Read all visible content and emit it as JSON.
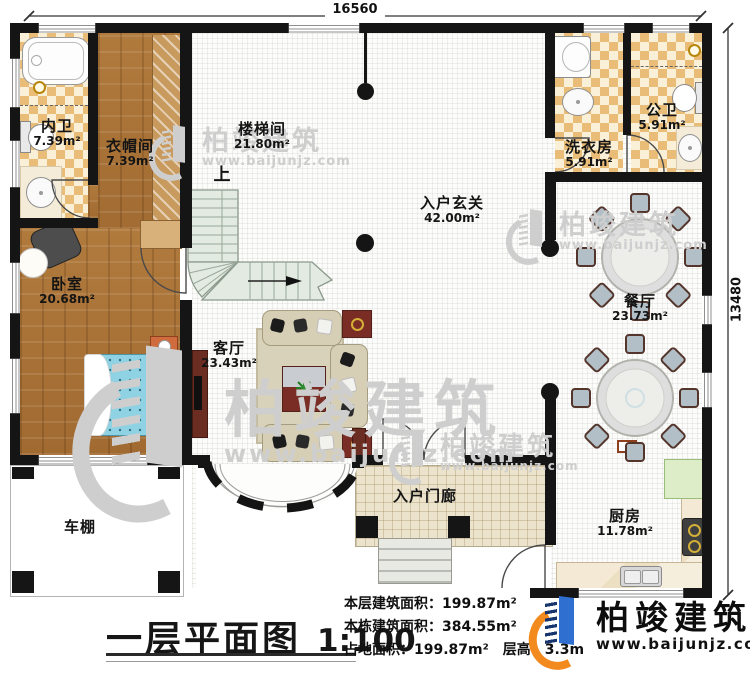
{
  "plan": {
    "title": "一层平面图",
    "scale": "1:100",
    "dimension_top": "16560",
    "dimension_right": "13480",
    "stair_direction_label": "上"
  },
  "rooms": [
    {
      "name": "内卫",
      "area": "7.39m²"
    },
    {
      "name": "衣帽间",
      "area": "7.39m²"
    },
    {
      "name": "楼梯间",
      "area": "21.80m²"
    },
    {
      "name": "入户玄关",
      "area": "42.00m²"
    },
    {
      "name": "洗衣房",
      "area": "5.91m²"
    },
    {
      "name": "公卫",
      "area": "5.91m²"
    },
    {
      "name": "卧室",
      "area": "20.68m²"
    },
    {
      "name": "客厅",
      "area": "23.43m²"
    },
    {
      "name": "餐厅",
      "area": "23.73m²"
    },
    {
      "name": "厨房",
      "area": "11.78m²"
    },
    {
      "name": "入户门廊",
      "area": ""
    },
    {
      "name": "车棚",
      "area": ""
    }
  ],
  "stats": {
    "floor_area": "本层建筑面积：199.87m²",
    "building_area": "本栋建筑面积：384.55m²",
    "land_area_and_height": "占地面积：199.87m²　层高：3.3m"
  },
  "branding": {
    "name": "柏竣建筑",
    "url": "www.baijunjz.com"
  },
  "colors": {
    "wall": "#151515",
    "wood_floor": "#ad7336",
    "tile_accent": "#e9bd77",
    "stair": "#e3eae2",
    "bed": "#8ed2e4",
    "brand_orange": "#f28a1e",
    "brand_blue_dark": "#16346e",
    "brand_blue": "#2f6fd0"
  }
}
